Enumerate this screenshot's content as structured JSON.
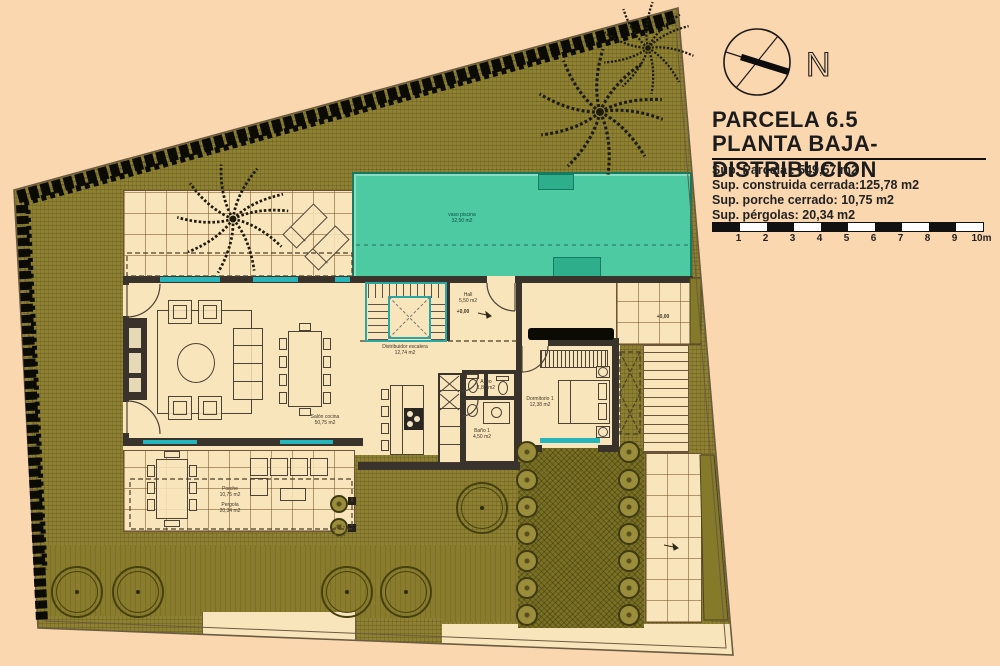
{
  "colors": {
    "bg": "#fbd7b0",
    "garden": "#8e8132",
    "garden_dark": "#7b7125",
    "grass": "#897c2c",
    "pool": "#4ecaa3",
    "pool_dark": "#157a62",
    "tile": "#f9e5bb",
    "wall": "#3a332b",
    "window": "#25b6bb",
    "stair": "#2aa7a5",
    "hedge": "#0b0b04",
    "ink": "#1c1c1c"
  },
  "compass": {
    "north_label": "N"
  },
  "title_block": {
    "title": "PARCELA 6.5",
    "subtitle": "PLANTA BAJA- DISTRIBUCION",
    "details": [
      "Sup. Parcela : 549,57 m2",
      "Sup. construida cerrada:125,78 m2",
      "Sup. porche cerrado: 10,75 m2",
      "Sup. pérgolas: 20,34 m2"
    ]
  },
  "scale_bar": {
    "ticks": [
      "1",
      "2",
      "3",
      "4",
      "5",
      "6",
      "7",
      "8",
      "9",
      "10m"
    ]
  },
  "rooms": {
    "salon": {
      "name": "Salón cocina",
      "area": "50,75 m2"
    },
    "distribuidor": {
      "name": "Distribuidor escalera",
      "area": "12,74 m2"
    },
    "hall": {
      "name": "Hall",
      "area": "5,50 m2",
      "level": "+0,00"
    },
    "aseo": {
      "name": "Aseo",
      "area": "1,80 m2"
    },
    "bano1": {
      "name": "Baño 1",
      "area": "4,50 m2"
    },
    "dormitorio1": {
      "name": "Dormitorio 1",
      "area": "12,38 m2"
    },
    "piscina": {
      "name": "vaso piscina",
      "area": "32,50 m2"
    },
    "porche": {
      "name": "Porche",
      "area": "10,75 m2"
    },
    "pergola": {
      "name": "Pergola",
      "area": "20,34 m2"
    },
    "terrace_level": "+0,00"
  }
}
